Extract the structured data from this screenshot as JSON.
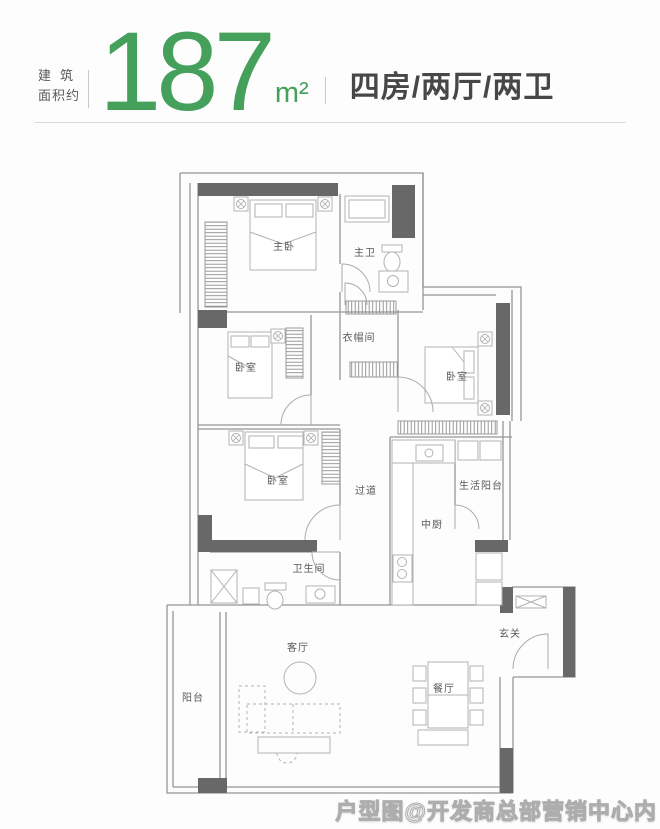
{
  "header": {
    "area_label_line1": "建筑",
    "area_label_line2": "面积约",
    "area_value": "187",
    "area_unit": "m²",
    "layout_text": "四房/两厅/两卫"
  },
  "colors": {
    "accent_green": "#45a05c",
    "wall_dark": "#686868",
    "line_gray": "#969696"
  },
  "floorplan": {
    "rooms": [
      {
        "id": "master-bedroom",
        "label": "主卧",
        "x": 284,
        "y": 250
      },
      {
        "id": "master-bath",
        "label": "主卫",
        "x": 365,
        "y": 256
      },
      {
        "id": "cloakroom",
        "label": "衣帽间",
        "x": 359,
        "y": 341
      },
      {
        "id": "bedroom-2",
        "label": "卧室",
        "x": 246,
        "y": 371
      },
      {
        "id": "bedroom-3",
        "label": "卧室",
        "x": 457,
        "y": 380
      },
      {
        "id": "bedroom-4",
        "label": "卧室",
        "x": 278,
        "y": 484
      },
      {
        "id": "hallway",
        "label": "过道",
        "x": 366,
        "y": 494
      },
      {
        "id": "service-balcony",
        "label": "生活阳台",
        "x": 481,
        "y": 489
      },
      {
        "id": "kitchen",
        "label": "中厨",
        "x": 432,
        "y": 528
      },
      {
        "id": "bathroom",
        "label": "卫生间",
        "x": 309,
        "y": 572
      },
      {
        "id": "foyer",
        "label": "玄关",
        "x": 510,
        "y": 637
      },
      {
        "id": "living-room",
        "label": "客厅",
        "x": 298,
        "y": 651
      },
      {
        "id": "dining-room",
        "label": "餐厅",
        "x": 444,
        "y": 692
      },
      {
        "id": "balcony",
        "label": "阳台",
        "x": 193,
        "y": 701
      }
    ]
  },
  "watermark": {
    "text": "户型图@开发商总部营销中心内"
  }
}
